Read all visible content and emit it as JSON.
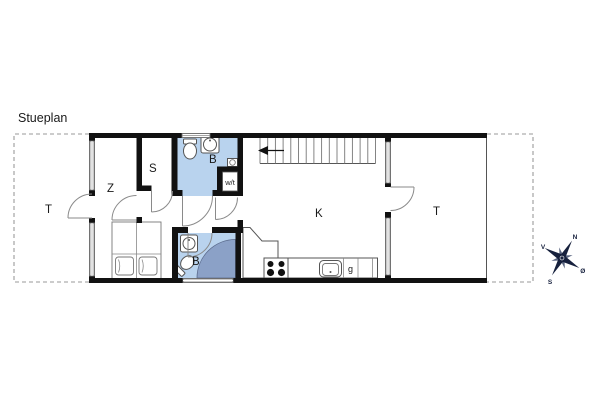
{
  "title": "Stueplan",
  "rooms": {
    "terrace_left": "T",
    "bedroom": "Z",
    "storage": "S",
    "bath_upper": "B",
    "washer_dryer": "w/t",
    "kitchen_living": "K",
    "bath_lower": "B",
    "appliance_g": "g",
    "terrace_right": "T"
  },
  "compass": {
    "north": "N",
    "east": "Ø",
    "south": "S",
    "west": "V"
  },
  "colors": {
    "wall": "#111111",
    "bath_fill": "#b9d3ee",
    "shower_fill": "#8ba1c7",
    "compass_dark": "#16203d",
    "compass_light": "#5a6580"
  }
}
